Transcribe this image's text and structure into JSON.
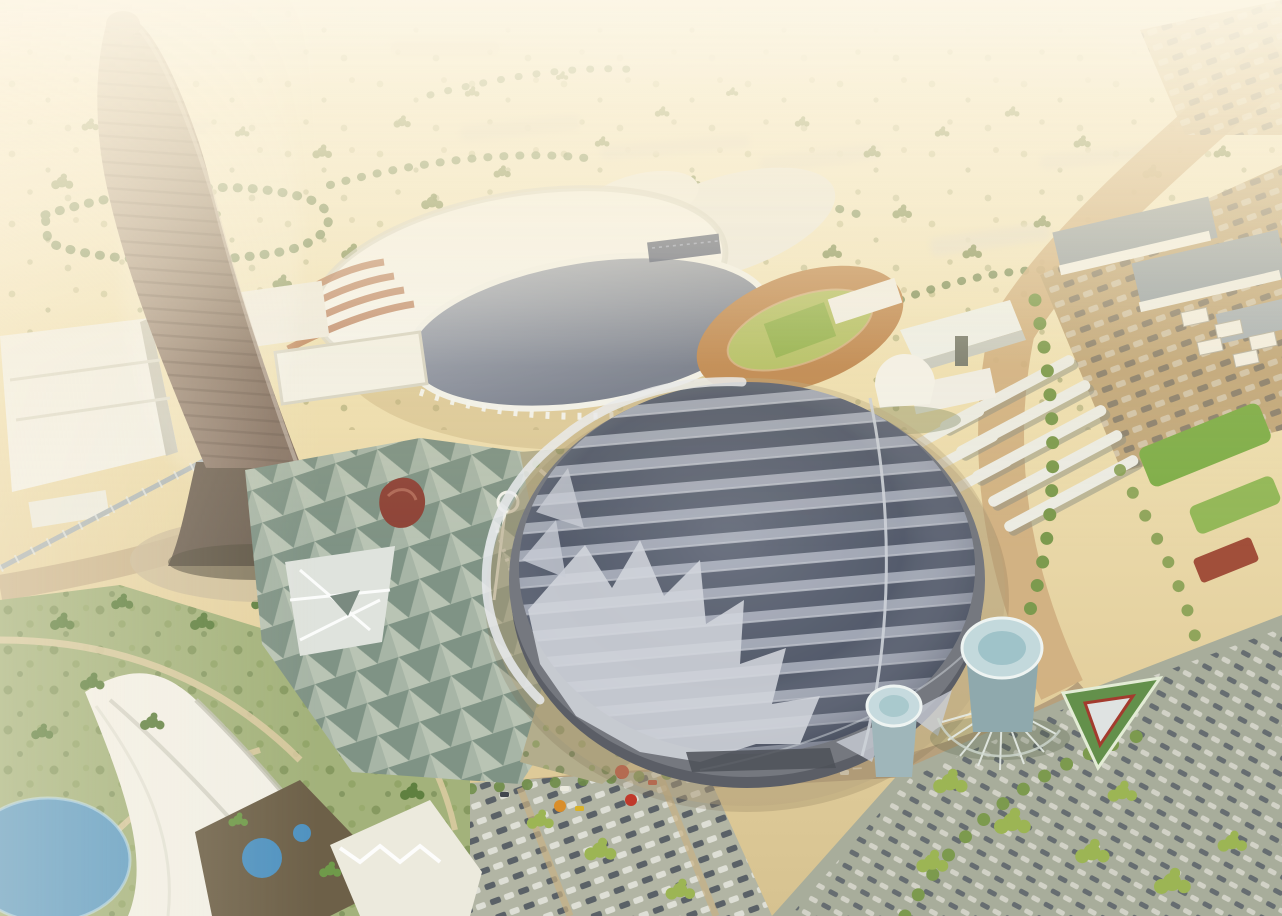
{
  "scene": {
    "type": "aerial-architectural-rendering",
    "landmarks": [
      "tapered-tower",
      "white-dome-arena",
      "athletics-track",
      "large-ribbed-stadium",
      "plaza-triangle-canopy",
      "gardens",
      "parking-lots",
      "water-towers",
      "desert-horizon"
    ]
  },
  "colors": {
    "sand_top": "#f7f1dc",
    "sand_mid": "#efe0b2",
    "sand_low": "#e3cf9d",
    "sand_deep": "#d6c290",
    "haze_white": "#ffffff",
    "tower_light": "#b7a493",
    "tower_dark": "#877466",
    "tower_base": "#6f6254",
    "dome_white": "#f6f5ef",
    "dome_shade": "#cfcfc6",
    "glass_light": "#a9afbc",
    "glass_dark": "#767d8e",
    "rib_light": "#a9aebb",
    "rib_dark": "#545b6b",
    "rib_edge": "#c8ccd5",
    "stadium_rim": "#75787f",
    "stadium_base": "#5b5e66",
    "stadium_wedge": "#d2d5dc",
    "roof_seam": "#cdd1d8",
    "track_tan": "#c08952",
    "track_infield": "#b5c167",
    "grass": "#a3b27b",
    "lawn_bright": "#7fae49",
    "tree_olive": "#7c9a4e",
    "tree_dark": "#5f8040",
    "tree_yellow": "#9cb554",
    "road_tan": "#cfae7f",
    "road_brown": "#9c5f4a",
    "asphalt_a": "#b2b5a4",
    "asphalt_b": "#a8ad9b",
    "parking_tan": "#c2a87c",
    "water_blue": "#5e9cc3",
    "pool_blue": "#4f92c0",
    "plaza_bg": "#b9c4b4",
    "tri_dark": "#7f9385",
    "garden_beige": "#b3ad8c",
    "cyl_top": "#c3d9dc",
    "cyl_body": "#8fa9ad",
    "red_accent": "#c0392b",
    "red_canopy": "#8e4438",
    "white_bldg": "#f2f0e6",
    "warehouse_roof": "#97a1a7",
    "car_dark": "#4b525c",
    "car_light": "#e6e6df",
    "island_green": "#63904b"
  }
}
